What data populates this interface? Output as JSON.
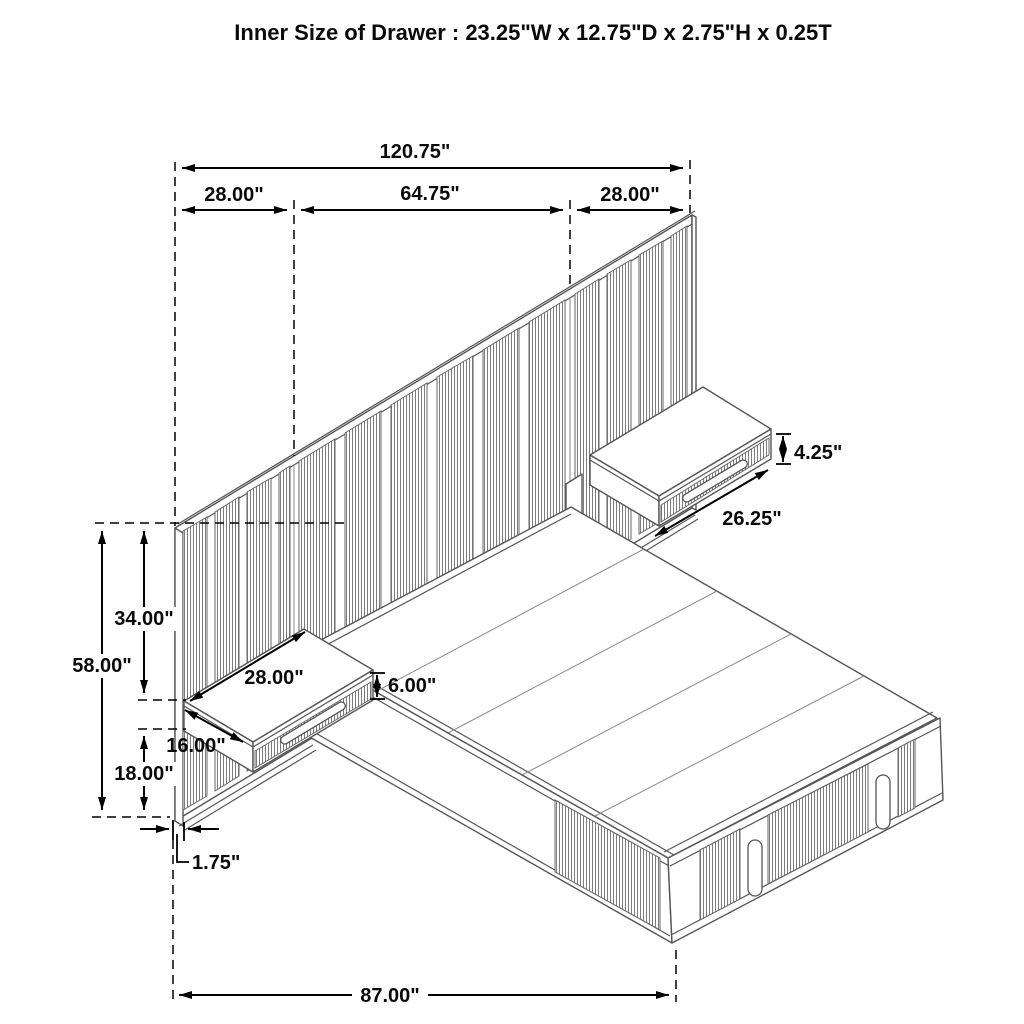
{
  "title": "Inner Size of Drawer : 23.25\"W x 12.75\"D x 2.75\"H x 0.25T",
  "dims": {
    "overall_width": "120.75\"",
    "left_section_width": "28.00\"",
    "center_section_width": "64.75\"",
    "right_section_width": "28.00\"",
    "right_shelf_front_height": "4.25\"",
    "right_shelf_width": "26.25\"",
    "upper_panel_height": "34.00\"",
    "total_panel_height": "58.00\"",
    "left_shelf_width": "28.00\"",
    "shelf_depth": "16.00\"",
    "shelf_box_height": "6.00\"",
    "lower_clearance": "18.00\"",
    "panel_thickness": "1.75\"",
    "bed_span": "87.00\""
  }
}
